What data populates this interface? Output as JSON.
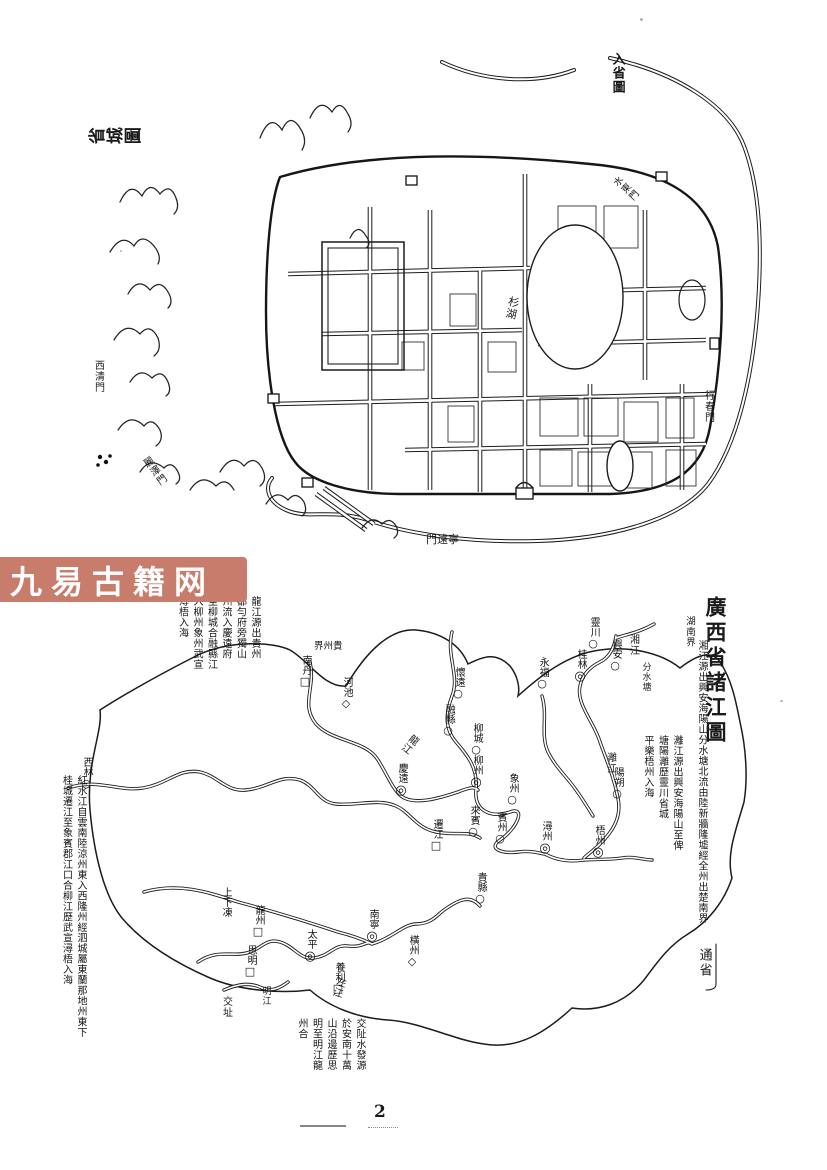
{
  "page": {
    "number": "2",
    "watermark": "九易古籍网"
  },
  "city_map": {
    "title": "省城圖",
    "corner_label": "入省圖",
    "labels": [
      {
        "id": "gate-xiqing",
        "text": "西清門",
        "x": 22,
        "y": 318,
        "mode": "v",
        "size": 10
      },
      {
        "id": "gate-lize",
        "text": "麗澤門",
        "x": 78,
        "y": 414,
        "mode": "v",
        "size": 10,
        "rot": -36
      },
      {
        "id": "gate-ningyuan",
        "text": "寧遠門",
        "x": 356,
        "y": 492,
        "mode": "h-rtl",
        "size": 11
      },
      {
        "id": "gate-xingchun",
        "text": "行春門",
        "x": 632,
        "y": 348,
        "mode": "v",
        "size": 10
      },
      {
        "id": "gate-shuidong",
        "text": "水東門",
        "x": 550,
        "y": 132,
        "mode": "v",
        "size": 9.5,
        "rot": -48
      },
      {
        "id": "lake-shanhu",
        "text": "杉湖",
        "x": 436,
        "y": 254,
        "mode": "v",
        "size": 11,
        "rot": 12
      }
    ]
  },
  "river_map": {
    "title": "廣西省諸江圖",
    "volume_label": "通省",
    "border_labels": [
      {
        "id": "border-hunan",
        "text": "湖南界",
        "x": 636,
        "y": 24,
        "mode": "v",
        "size": 9.5
      },
      {
        "id": "border-guizhou",
        "text": "貴州界",
        "x": 266,
        "y": 50,
        "mode": "h-rtl",
        "size": 9.5
      },
      {
        "id": "border-jiaozhi",
        "text": "交址",
        "x": 172,
        "y": 404,
        "mode": "v",
        "size": 10
      }
    ],
    "river_labels": [
      {
        "id": "river-longjiang",
        "text": "龍江",
        "x": 355,
        "y": 140,
        "rot": 38,
        "size": 10
      },
      {
        "id": "river-xiangjiang",
        "text": "湘江",
        "x": 579,
        "y": 42,
        "rot": 0,
        "size": 10
      },
      {
        "id": "label-fenshuitang",
        "text": "分水塘",
        "x": 592,
        "y": 70,
        "rot": 0,
        "size": 9
      },
      {
        "id": "river-lijiang",
        "text": "灕江",
        "x": 556,
        "y": 160,
        "rot": 0,
        "size": 10
      },
      {
        "id": "river-zuojiang",
        "text": "左江",
        "x": 284,
        "y": 384,
        "rot": 18,
        "size": 10
      },
      {
        "id": "river-mingjiang",
        "text": "明江",
        "x": 212,
        "y": 394,
        "rot": 0,
        "size": 9
      }
    ],
    "towns": [
      {
        "name": "西林",
        "sym": "○",
        "x": 38,
        "y": 198
      },
      {
        "name": "南丹",
        "sym": "□",
        "x": 257,
        "y": 96
      },
      {
        "name": "河池",
        "sym": "◇",
        "x": 298,
        "y": 118
      },
      {
        "name": "慶遠",
        "sym": "◎",
        "x": 353,
        "y": 204
      },
      {
        "name": "懷遠",
        "sym": "○",
        "x": 410,
        "y": 108
      },
      {
        "name": "融縣",
        "sym": "○",
        "x": 400,
        "y": 145
      },
      {
        "name": "柳城",
        "sym": "○",
        "x": 428,
        "y": 164
      },
      {
        "name": "柳州",
        "sym": "◎",
        "x": 428,
        "y": 196
      },
      {
        "name": "象州",
        "sym": "○",
        "x": 464,
        "y": 214
      },
      {
        "name": "來賓",
        "sym": "○",
        "x": 425,
        "y": 246
      },
      {
        "name": "遷江",
        "sym": "□",
        "x": 388,
        "y": 260
      },
      {
        "name": "賓州",
        "sym": "○",
        "x": 452,
        "y": 253
      },
      {
        "name": "潯州",
        "sym": "◎",
        "x": 497,
        "y": 262
      },
      {
        "name": "梧州",
        "sym": "◎",
        "x": 550,
        "y": 266
      },
      {
        "name": "貴縣",
        "sym": "○",
        "x": 432,
        "y": 313
      },
      {
        "name": "桂林",
        "sym": "◎",
        "x": 532,
        "y": 90
      },
      {
        "name": "靈川",
        "sym": "○",
        "x": 545,
        "y": 58
      },
      {
        "name": "興安",
        "sym": "○",
        "x": 567,
        "y": 80
      },
      {
        "name": "永福",
        "sym": "○",
        "x": 494,
        "y": 98
      },
      {
        "name": "陽朔",
        "sym": "○",
        "x": 569,
        "y": 208
      },
      {
        "name": "太平",
        "sym": "◎",
        "x": 262,
        "y": 370
      },
      {
        "name": "南寧",
        "sym": "◎",
        "x": 324,
        "y": 350
      },
      {
        "name": "龍州",
        "sym": "□",
        "x": 210,
        "y": 346
      },
      {
        "name": "上下凍",
        "sym": "",
        "x": 177,
        "y": 338
      },
      {
        "name": "思明",
        "sym": "□",
        "x": 202,
        "y": 386
      },
      {
        "name": "養利",
        "sym": "□",
        "x": 290,
        "y": 403
      },
      {
        "name": "橫州",
        "sym": "◇",
        "x": 364,
        "y": 376
      }
    ],
    "annotations": [
      {
        "x": 128,
        "y": 4,
        "w": 84,
        "h": 150,
        "size": 10,
        "cols": [
          "龍江源出貴州",
          "都勻府旁獨山",
          "州流入慶遠府",
          "至柳城合融縣江",
          "入柳州象州武宣",
          "潯梧入海"
        ]
      },
      {
        "x": 644,
        "y": 48,
        "w": 15,
        "h": 300,
        "size": 10,
        "cols": [
          "湘江源出興安海陽山分水塘北流由陸新牆隆墟經全州出楚南界"
        ]
      },
      {
        "x": 590,
        "y": 143,
        "w": 44,
        "h": 140,
        "size": 10,
        "cols": [
          "灕江源出興安海陽山至俾",
          "塘陽灕歷靈川省城",
          "平樂梧州入海"
        ]
      },
      {
        "x": 8,
        "y": 183,
        "w": 30,
        "h": 292,
        "size": 10,
        "cols": [
          "紅水江自雲南陸涼州東入西隆州經泗城屬東蘭那地州東下",
          "桂城遷江至象賓郡江口合柳江歷武宣潯梧入海"
        ]
      },
      {
        "x": 247,
        "y": 426,
        "w": 70,
        "h": 84,
        "size": 10,
        "cols": [
          "交阯水發源",
          "於安南十萬",
          "山沿邊歷思",
          "明至明江龍",
          "州合"
        ]
      }
    ]
  }
}
